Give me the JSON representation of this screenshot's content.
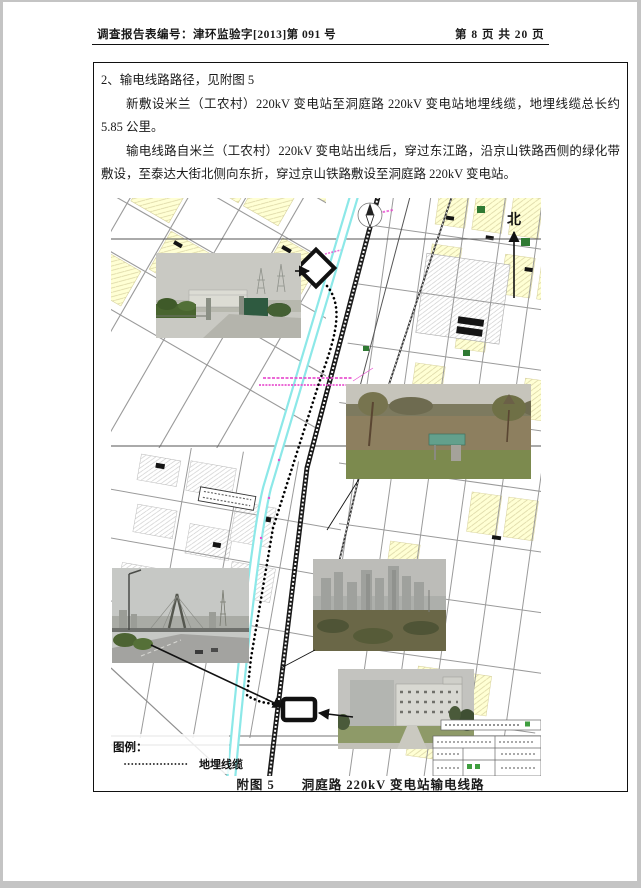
{
  "header": {
    "report_no": "调查报告表编号：津环监验字[2013]第 091 号",
    "page_info": "第 8 页 共 20 页"
  },
  "content": {
    "heading": "2、输电线路路径，见附图 5",
    "paragraph1": "新敷设米兰（工农村）220kV 变电站至洞庭路 220kV 变电站地埋线缆，地埋线缆总长约 5.85 公里。",
    "paragraph2": "输电线路自米兰（工农村）220kV 变电站出线后，穿过东江路，沿京山铁路西侧的绿化带敷设，至泰达大街北侧向东折，穿过京山铁路敷设至洞庭路 220kV 变电站。",
    "caption": "附图 5　　洞庭路 220kV 变电站输电线路"
  },
  "map": {
    "north_label": "北",
    "legend": {
      "title": "图例：",
      "items": [
        {
          "symbol": "dotted-line",
          "label": "地埋线缆"
        }
      ]
    },
    "colors": {
      "canal": "#8ce8e8",
      "parcel": "#ffffd4",
      "route": "#111111",
      "annotation": "#e84fd0"
    }
  }
}
